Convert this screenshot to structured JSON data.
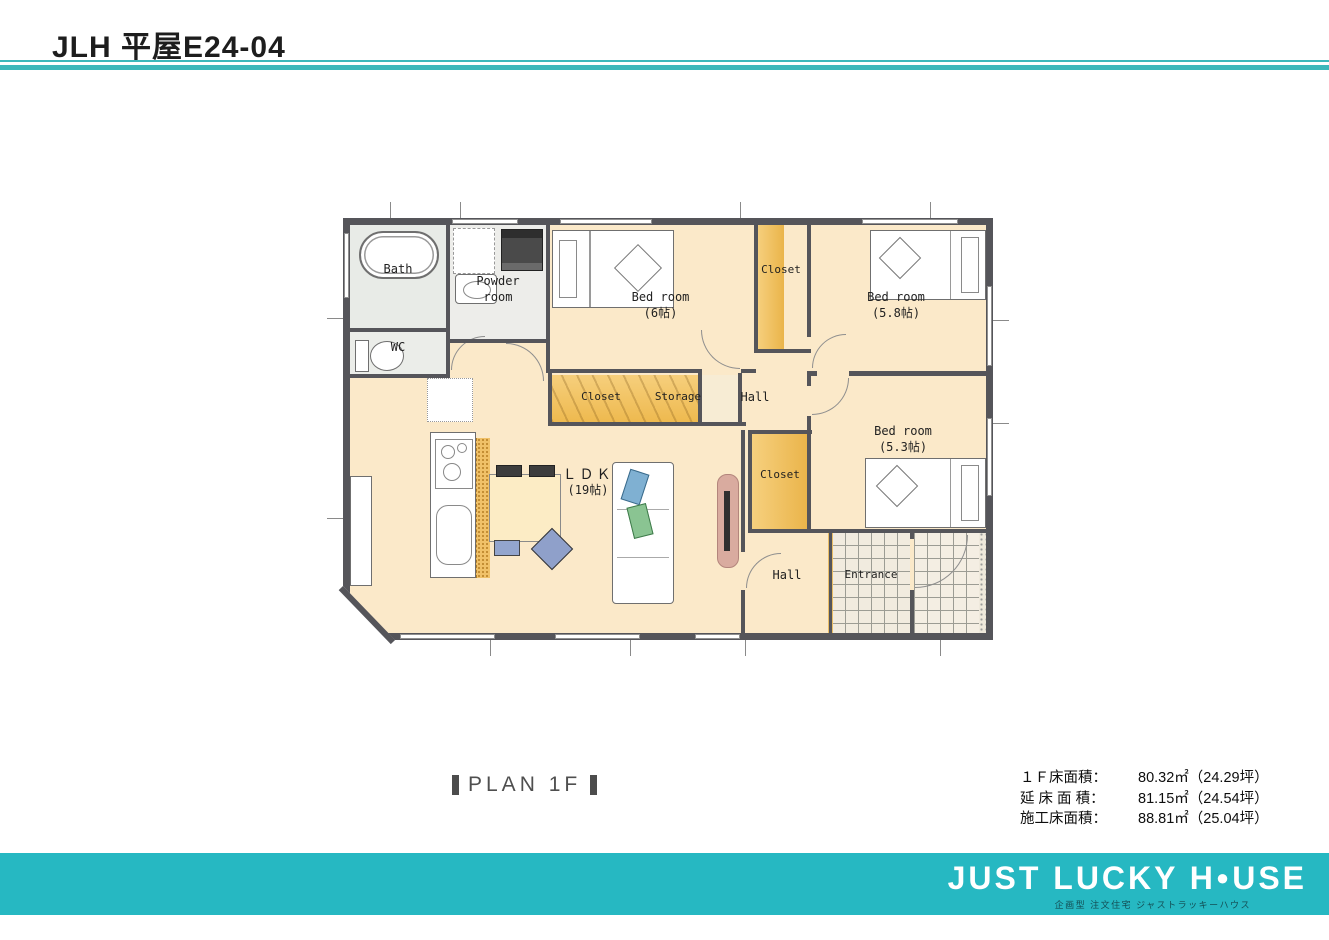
{
  "page": {
    "title": "JLH  平屋E24-04"
  },
  "colors": {
    "accent_teal": "#3cb7ba",
    "footer_teal": "#26b8c2",
    "floor_peach": "#fbe9c9",
    "closet_yellow": "#eab44a",
    "wall_gray": "#55555a"
  },
  "plan": {
    "caption": "PLAN 1F",
    "rooms": {
      "bath": "Bath",
      "powder_room": "Powder\nroom",
      "wc": "WC",
      "bedroom_6": "Bed room\n(6帖)",
      "closet_top": "Closet",
      "bedroom_58": "Bed room\n(5.8帖)",
      "closet_mid": "Closet",
      "storage": "Storage",
      "hall_mid": "Hall",
      "bedroom_53": "Bed room\n(5.3帖)",
      "closet_low": "Closet",
      "ldk_line1": "ＬＤＫ",
      "ldk_line2": "(19帖)",
      "hall_low": "Hall",
      "entrance": "Entrance"
    }
  },
  "areas": {
    "rows": [
      {
        "label": "１Ｆ床面積：",
        "value": "80.32㎡（24.29坪）"
      },
      {
        "label": "延 床 面 積：",
        "value": "81.15㎡（24.54坪）"
      },
      {
        "label": "施工床面積：",
        "value": "88.81㎡（25.04坪）"
      }
    ]
  },
  "footer": {
    "logo_left": "JUST LUCKY H",
    "logo_o": "●",
    "logo_right": "USE",
    "tagline": "企画型 注文住宅 ジャストラッキーハウス"
  }
}
